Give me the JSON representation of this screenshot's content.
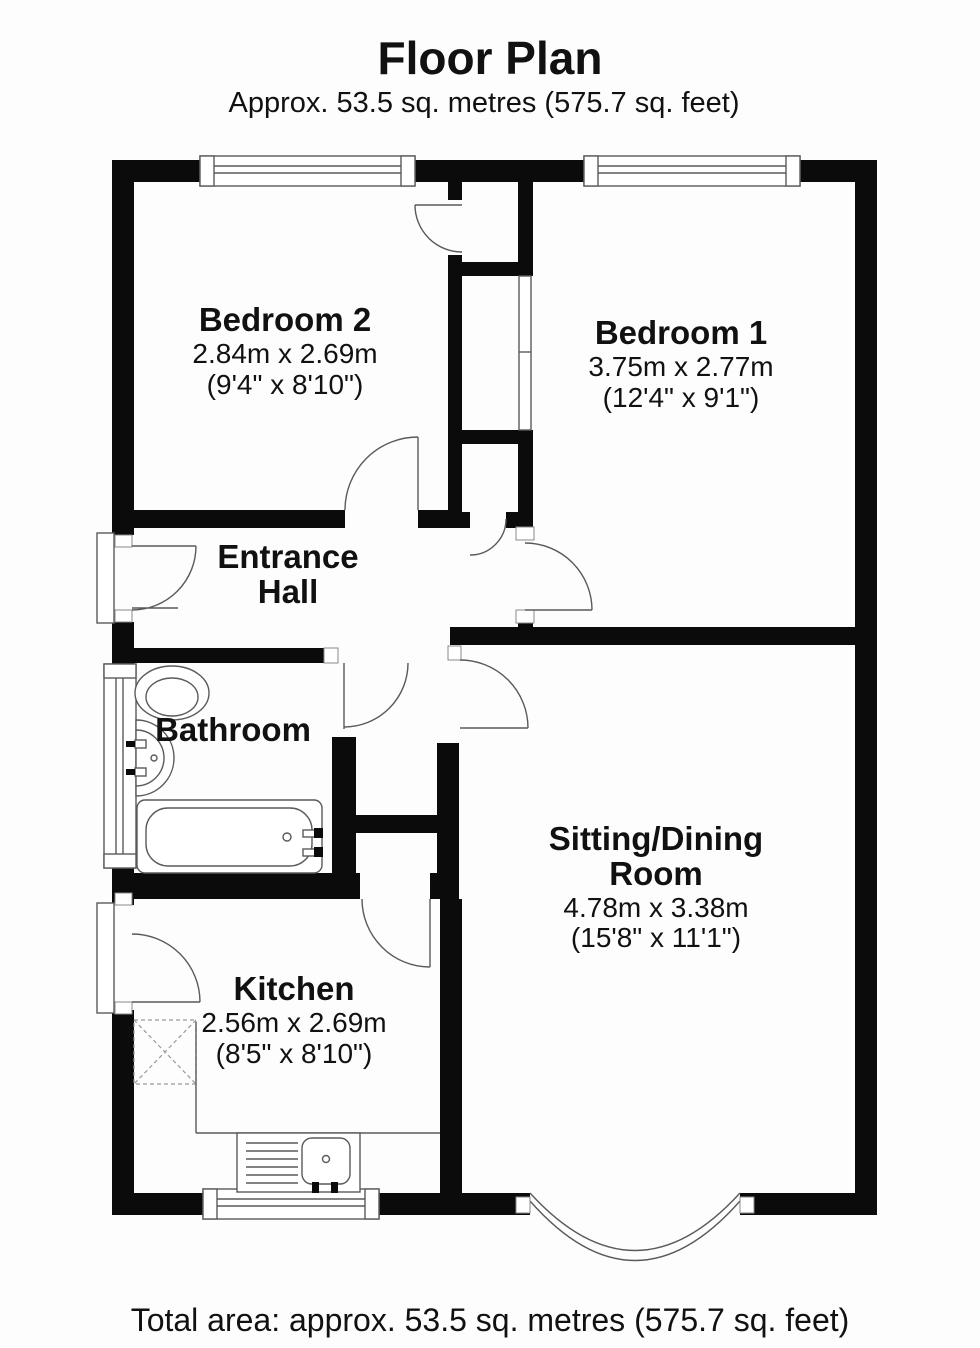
{
  "meta": {
    "title": "Floor Plan",
    "subtitle": "Approx. 53.5 sq. metres (575.7 sq. feet)",
    "footer": "Total area: approx. 53.5 sq. metres (575.7 sq. feet)"
  },
  "rooms": [
    {
      "id": "bedroom-2",
      "name": "Bedroom 2",
      "metric": "2.84m x 2.69m",
      "imperial": "(9'4\" x 8'10\")"
    },
    {
      "id": "bedroom-1",
      "name": "Bedroom 1",
      "metric": "3.75m x 2.77m",
      "imperial": "(12'4\" x 9'1\")"
    },
    {
      "id": "entrance-hall",
      "name_line1": "Entrance",
      "name_line2": "Hall"
    },
    {
      "id": "bathroom",
      "name": "Bathroom"
    },
    {
      "id": "sitting-dining-room",
      "name_line1": "Sitting/Dining",
      "name_line2": "Room",
      "metric": "4.78m x 3.38m",
      "imperial": "(15'8\" x 11'1\")"
    },
    {
      "id": "kitchen",
      "name": "Kitchen",
      "metric": "2.56m x 2.69m",
      "imperial": "(8'5\" x 8'10\")"
    }
  ],
  "fixtures": [
    "toilet-icon",
    "basin-icon",
    "bathtub-icon",
    "kitchen-sink-icon",
    "appliance-space-icon",
    "built-in-wardrobe"
  ],
  "windows": [
    "bedroom-2-window",
    "bedroom-1-window",
    "bathroom-window",
    "kitchen-window",
    "bay-window"
  ],
  "doors": [
    "front-door",
    "back-door",
    "bedroom-2-door",
    "bedroom-1-door",
    "bathroom-door",
    "sitting-room-door",
    "kitchen-door",
    "airing-cupboard-door",
    "wardrobe-door"
  ],
  "colors": {
    "wall": "#0b0b0b",
    "line": "#5a5a5a",
    "jamb": "#8a8a8a",
    "background": "#fdfdfd",
    "text": "#111111"
  }
}
